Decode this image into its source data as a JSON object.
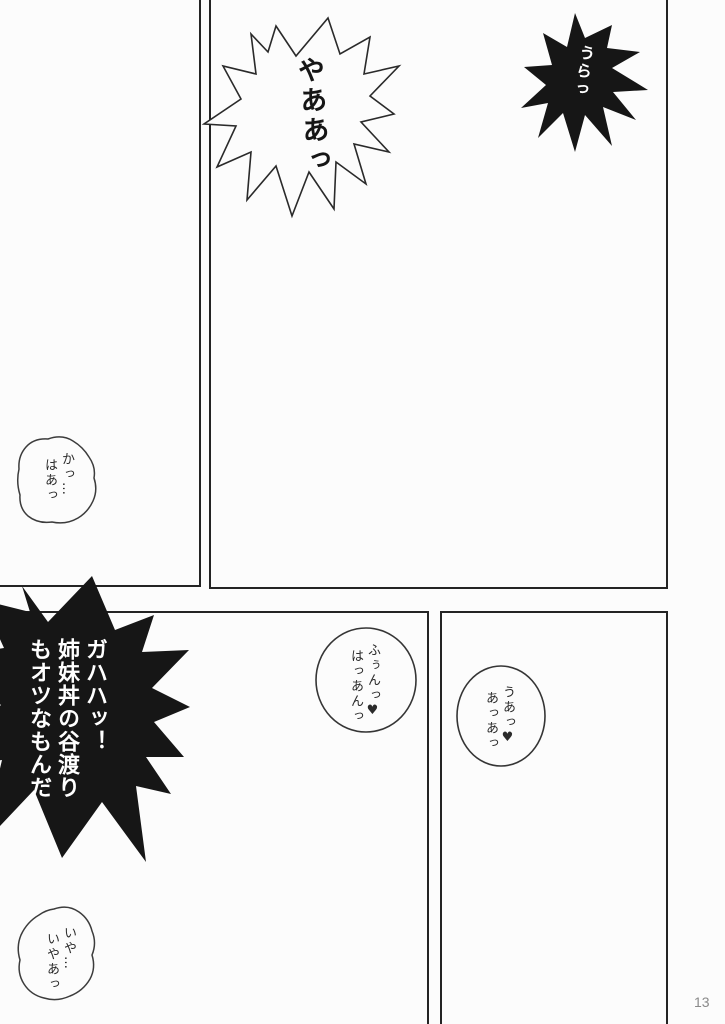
{
  "page": {
    "number_label": "13",
    "background_color": "#fcfcfc",
    "panel_border_color": "#242424",
    "burst_fill_color": "#161616",
    "bubble_fill_color": "#fcfcfc"
  },
  "speech": {
    "burst_top_white": {
      "lines": [
        "やああっ"
      ]
    },
    "burst_top_right_black": {
      "lines": [
        "うらっ"
      ]
    },
    "burst_bottom_left_black": {
      "lines": [
        "ガハハッ！",
        "姉妹丼の谷渡り",
        "もオツなもんだ"
      ]
    },
    "cloud_left": {
      "lines": [
        "かっ…",
        "はあっ"
      ]
    },
    "circle_middle": {
      "lines": [
        "ふぅんっ♥",
        "はっあんっ"
      ]
    },
    "circle_right": {
      "lines": [
        "うあっ♥",
        "あっあっ"
      ]
    },
    "cloud_bottom_left": {
      "lines": [
        "いや…",
        "いやあっ"
      ]
    }
  }
}
